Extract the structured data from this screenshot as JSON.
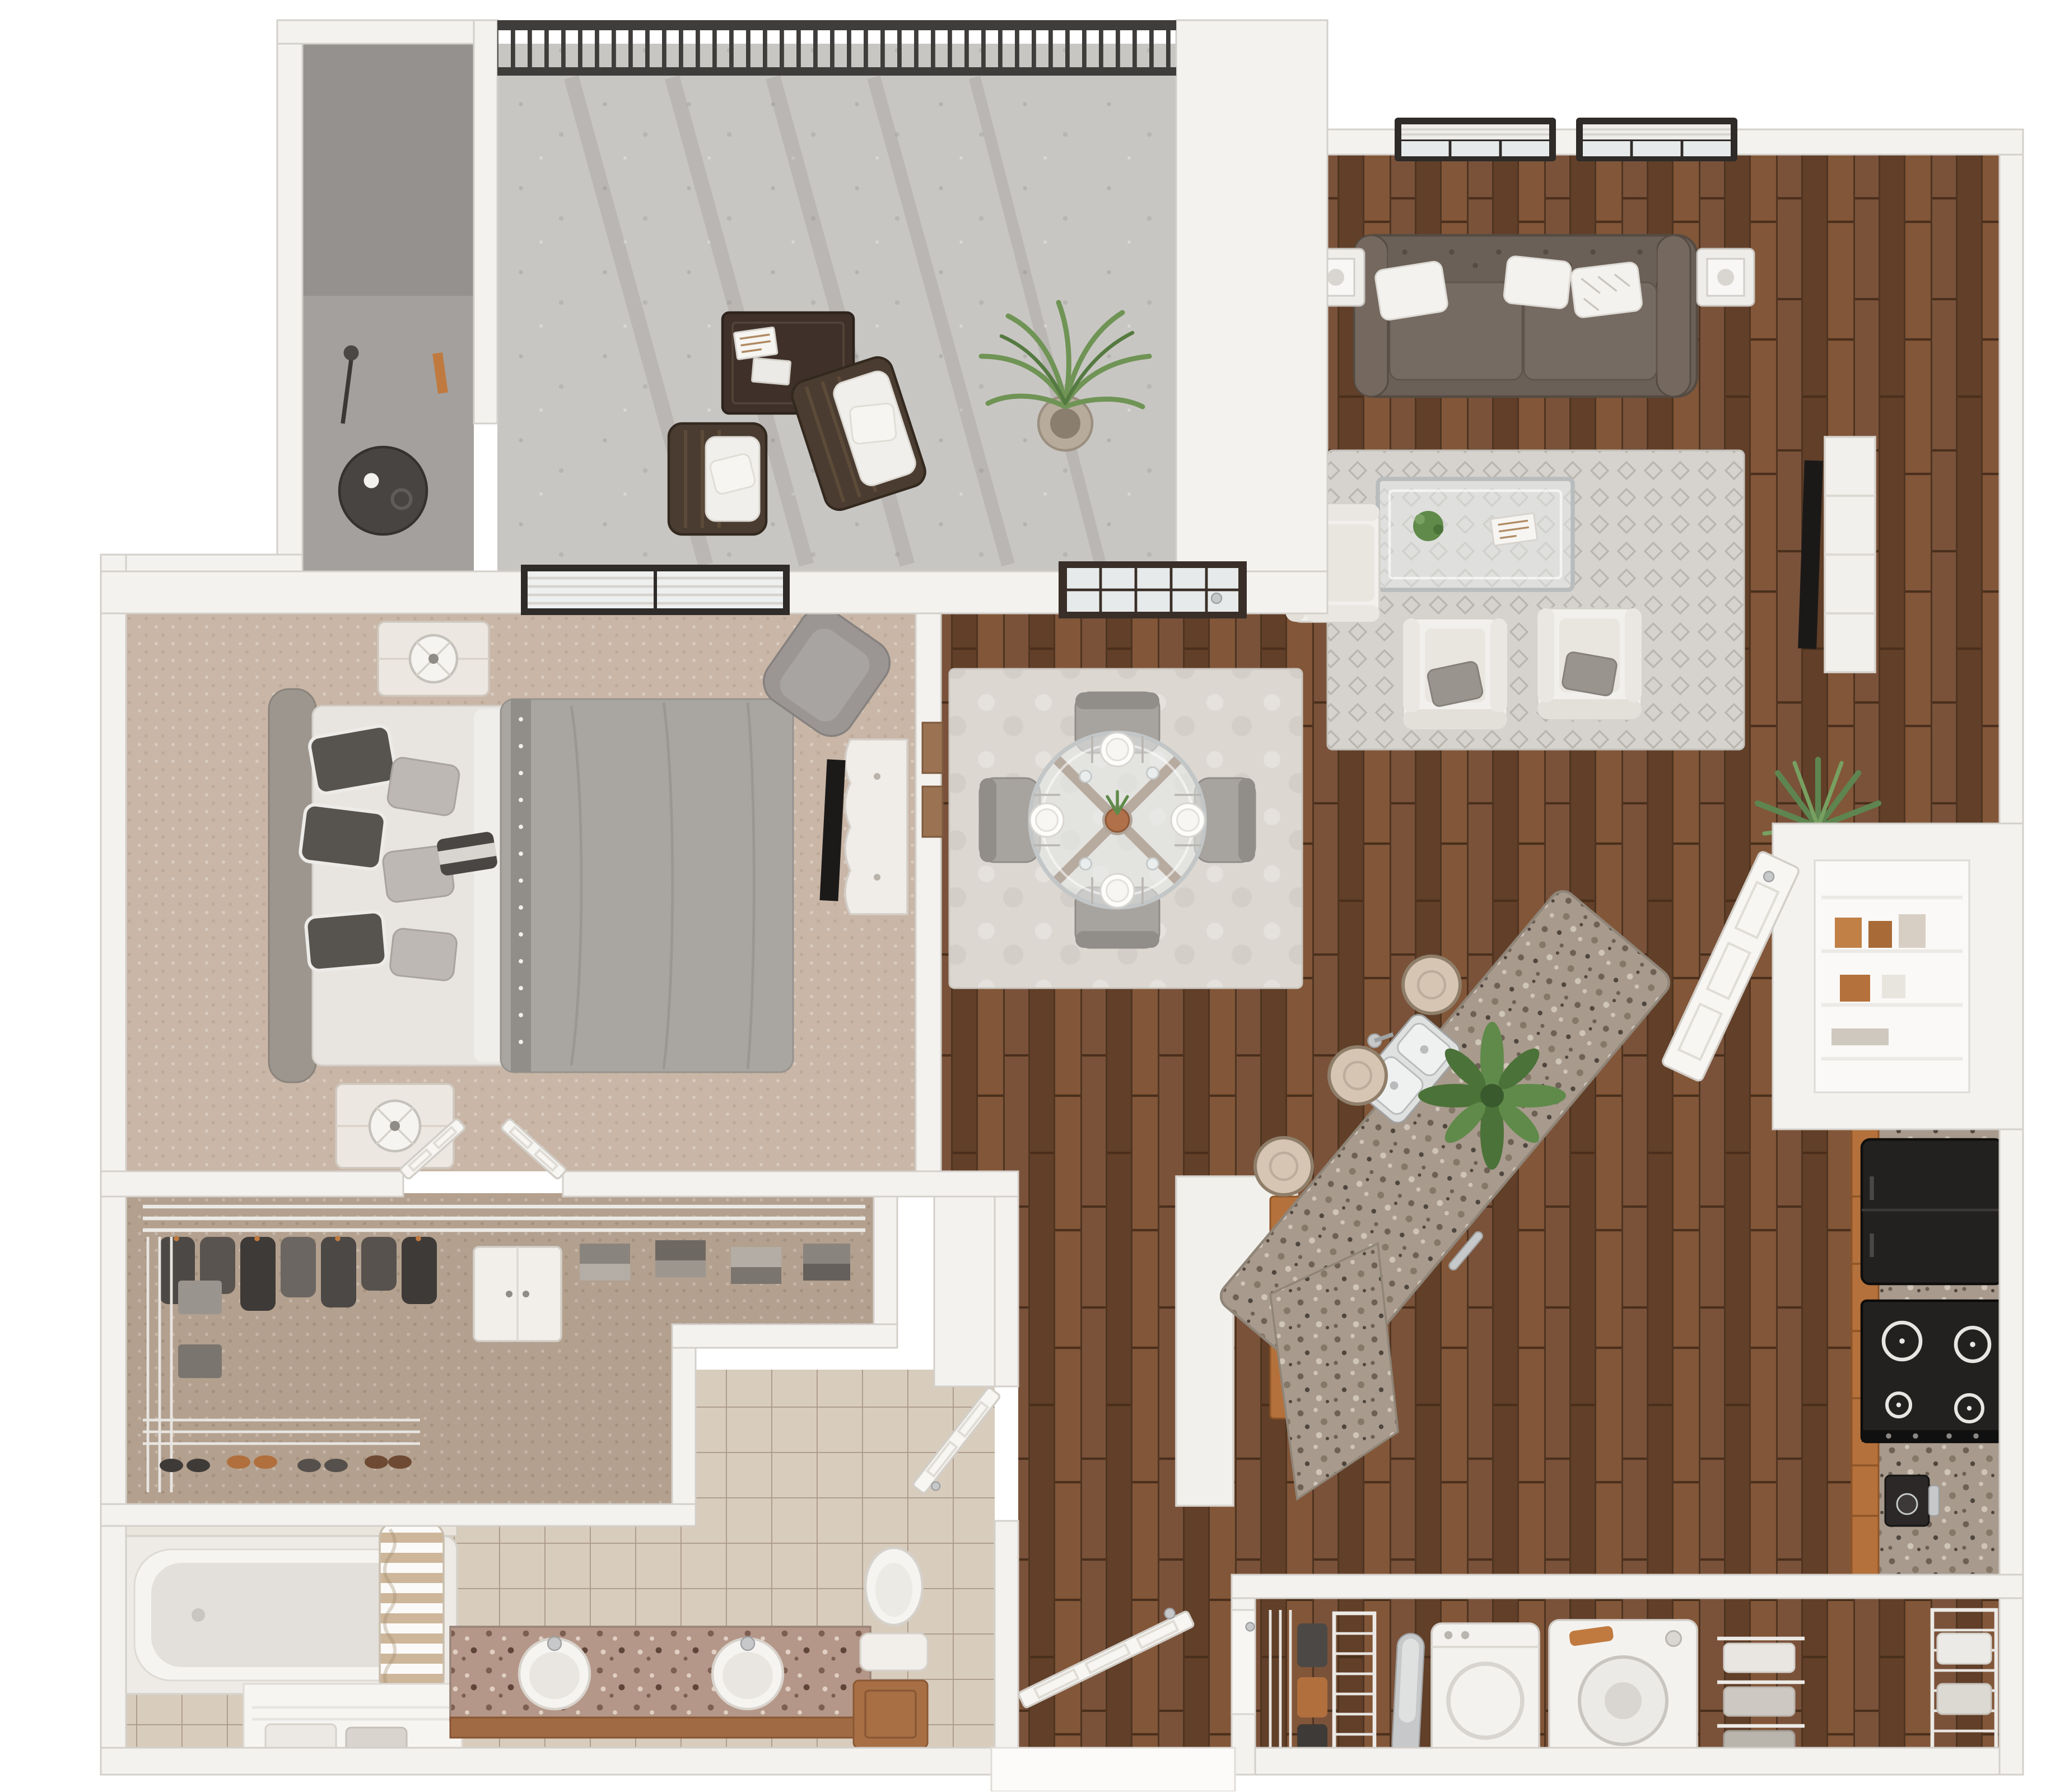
{
  "meta": {
    "type": "3d-floor-plan",
    "description": "Top-down 3D rendering of a one-bedroom, one-bathroom apartment with balcony, open living/dining/kitchen, walk-in closet and laundry closet",
    "visible_text": "none"
  },
  "colors": {
    "background": "#ffffff",
    "wall": "#f4f2ef",
    "floor_hardwood": "#6e4a33",
    "floor_carpet_bedroom": "#c9b6a6",
    "floor_carpet_closet": "#b3a08e",
    "floor_tile_bathroom": "#d8ccbd",
    "floor_concrete_balcony": "#c8c6c3",
    "rug_living": "#d6d3cf",
    "rug_dining": "#dcd7d1",
    "sofa_leather": "#6b6057",
    "pillow_white": "#f4f2ef",
    "pillow_dark": "#57534f",
    "armchair_white": "#f2f0ed",
    "bed_duvet": "#a9a5a1",
    "bed_sheets": "#e8e5e1",
    "headboard": "#9d968e",
    "cabinet_wood": "#b5713b",
    "granite_counter": "#a89a8c",
    "granite_vanity": "#b49788",
    "appliance_black": "#232120",
    "appliance_white": "#f4f2ef",
    "railing_metal": "#3f3d3b",
    "door_dark_frame": "#3a2f28",
    "window_frame": "#2e2b29",
    "glass": "#e7eaea",
    "plant_green": "#5f8a4a",
    "accent_orange": "#c07a3f",
    "wire_shelving": "#eceae6"
  },
  "rooms": [
    {
      "id": "balcony",
      "name": "Balcony",
      "floor": "concrete",
      "items": [
        "metal-railing",
        "outdoor-coffee-table",
        "magazines",
        "lounge-chair x2 with white cushions",
        "potted-palm",
        "storage-nook",
        "bistro-table",
        "cup",
        "floor-lamp",
        "umbrella-orange"
      ]
    },
    {
      "id": "living-room",
      "name": "Living Room",
      "floor": "hardwood",
      "items": [
        "window-with-blinds x2",
        "chesterfield-sofa",
        "sofa-pillows x3",
        "lantern-side-table x2 with white lamps",
        "area-rug",
        "glass-coffee-table",
        "coffee-table-plant",
        "magazine",
        "armchair-white x3",
        "armchair-pillow-gray x2",
        "media-console",
        "flat-tv",
        "accent-plant-agave"
      ]
    },
    {
      "id": "dining-area",
      "name": "Dining Area",
      "floor": "hardwood",
      "items": [
        "area-rug",
        "round-glass-dining-table",
        "dining-chair x4",
        "place-setting x4",
        "drink-glass x4",
        "centerpiece-vase",
        "balcony-french-door",
        "wall-frames x2"
      ]
    },
    {
      "id": "kitchen",
      "name": "Kitchen",
      "floor": "hardwood",
      "items": [
        "granite-island",
        "island-sink-double",
        "island-faucet",
        "bar-stool x3",
        "island-plant",
        "island-base-cabinet",
        "dishwasher-handle",
        "pantry",
        "pantry-wire-shelves",
        "pantry-boxes",
        "pantry-door",
        "refrigerator-black",
        "range-4-burner",
        "coffee-maker",
        "wood-cabinets",
        "granite-counter"
      ]
    },
    {
      "id": "bedroom",
      "name": "Bedroom",
      "floor": "carpet",
      "items": [
        "window-with-blinds",
        "bed-queen",
        "headboard",
        "duvet-gray-nailhead",
        "pillow-dark x3",
        "pillow-light x3",
        "pillow-accent",
        "nightstand x2",
        "table-lamp x2",
        "armchair-gray",
        "dresser-with-tv",
        "double-doors-to-closet"
      ]
    },
    {
      "id": "walk-in-closet",
      "name": "Walk-in Closet",
      "floor": "carpet",
      "items": [
        "wire-shelving",
        "hanging-clothes",
        "folded-clothes",
        "storage-cabinet-white",
        "storage-bins",
        "shoe-rack",
        "shoes"
      ]
    },
    {
      "id": "bathroom",
      "name": "Bathroom",
      "floor": "tile",
      "items": [
        "bathtub-shower",
        "tile-surround",
        "shower-curtain-striped",
        "tub-faucet",
        "granite-vanity-double",
        "vanity-sink x2",
        "vanity-faucet x2",
        "toilet",
        "wood-hamper",
        "linen-shelves",
        "towels",
        "bathroom-door"
      ]
    },
    {
      "id": "hall-entry",
      "name": "Hall / Entry",
      "floor": "hardwood",
      "items": [
        "entry-door-open",
        "entry-landing"
      ]
    },
    {
      "id": "laundry",
      "name": "Laundry Closet",
      "floor": "hardwood",
      "items": [
        "laundry-door",
        "wire-shelving",
        "storage-items",
        "ironing-board",
        "dryer",
        "washer-orange-handle",
        "towel-stacks"
      ]
    }
  ],
  "counts": {
    "bedrooms": 1,
    "bathrooms": 1,
    "dining_chairs": 4,
    "place_settings": 4,
    "bar_stools": 3,
    "living_armchairs": 3,
    "sofa_pillows": 3,
    "bed_pillows": 7,
    "bathroom_sinks": 2,
    "range_burners": 4,
    "living_windows": 2,
    "balcony_chairs": 2,
    "nightstands": 2
  }
}
